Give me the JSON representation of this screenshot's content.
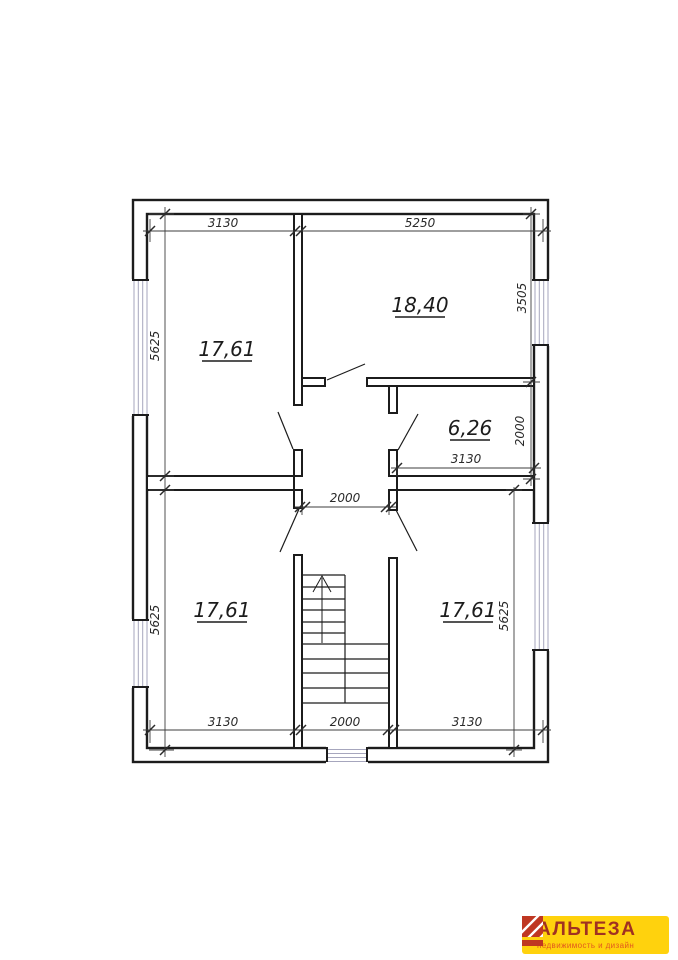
{
  "plan": {
    "rooms": [
      {
        "name": "top-left-room",
        "area": "17,61"
      },
      {
        "name": "top-right-room",
        "area": "18,40"
      },
      {
        "name": "mid-right-room",
        "area": "6,26"
      },
      {
        "name": "bottom-left-room",
        "area": "17,61"
      },
      {
        "name": "bottom-right-room",
        "area": "17,61"
      }
    ],
    "dims": {
      "top_left_w": "3130",
      "top_right_w": "5250",
      "left_top_h": "5625",
      "left_bottom_h": "5625",
      "right_top_h": "3505",
      "right_mid_h": "2000",
      "right_bottom_h": "5625",
      "room626_w": "3130",
      "hall_w": "2000",
      "bottom_left_w": "3130",
      "bottom_center_w": "2000",
      "bottom_right_w": "3130"
    },
    "colors": {
      "wall": "#1c1c1c",
      "dimension": "#3d3d3d",
      "window": "#a6a6bd"
    }
  },
  "logo": {
    "title": "АЛЬТЕЗА",
    "subtitle": "недвижимость и дизайн",
    "colors": {
      "background": "#ffd20d",
      "title": "#a03122",
      "subtitle": "#e2571f",
      "icon": "#bf3722"
    }
  }
}
